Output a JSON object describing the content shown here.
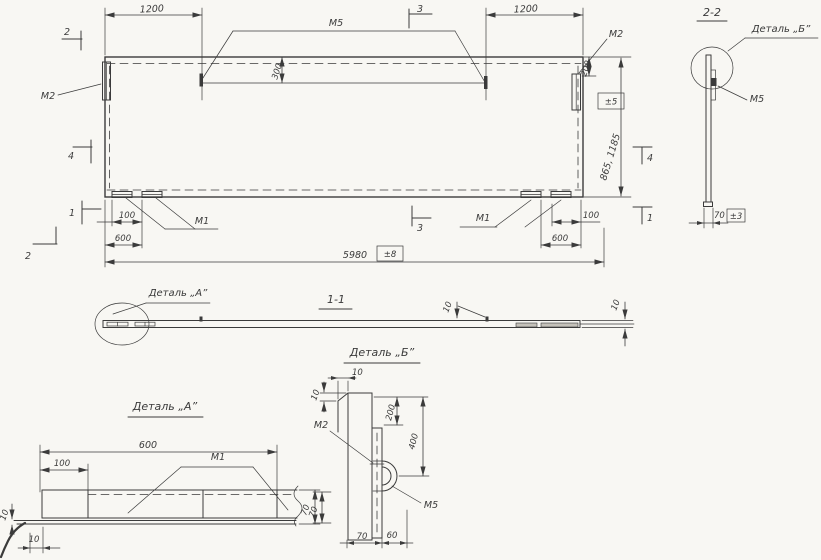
{
  "page": {
    "bg": "#f8f7f3",
    "ink": "#3b3b3b"
  },
  "main_view": {
    "dims": {
      "left_1200": "1200",
      "right_1200": "1200",
      "weld_offset": "300",
      "right_200": "200",
      "height": "865, 1185",
      "height_tol": "±5",
      "left_100": "100",
      "left_600": "600",
      "right_100": "100",
      "right_600": "600",
      "length": "5980",
      "length_tol": "±8"
    },
    "welds": {
      "m5": "М5",
      "m2_left": "М2",
      "m2_right": "М2",
      "m1_left": "М1",
      "m1_right": "М1"
    },
    "markers": {
      "top_left": "2",
      "top_mid": "3",
      "left_mid": "4",
      "left_low": "1",
      "bottom_left": "2",
      "bottom_mid": "3",
      "right_mid": "4",
      "right_low": "1"
    }
  },
  "section_2_2": {
    "title": "2-2",
    "callout": "Деталь „Б”",
    "weld": "М5",
    "width": "70",
    "width_tol": "±3"
  },
  "section_1_1": {
    "title": "1-1",
    "callout": "Деталь „А”",
    "thickness_mid": "10",
    "thickness_end": "10"
  },
  "detail_a": {
    "title": "Деталь „А”",
    "weld": "М1",
    "length": "600",
    "offset": "100",
    "width": "70",
    "thickness": "10",
    "overhang": "10"
  },
  "detail_b": {
    "title": "Деталь „Б”",
    "plate": "М2",
    "loop": "М5",
    "lip_width": "10",
    "lip_height": "10",
    "plate_offset": "200",
    "loop_offset": "400",
    "side": "70",
    "width": "70",
    "loop_width": "60"
  }
}
